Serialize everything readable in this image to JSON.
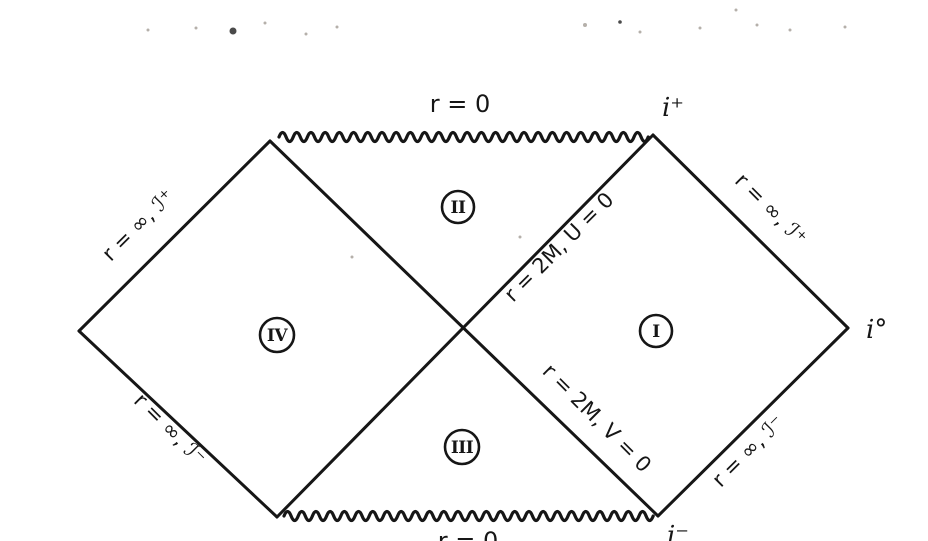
{
  "diagram": {
    "description": "Penrose conformal diagram of the maximally extended Schwarzschild spacetime",
    "ink_color": "#161616",
    "paper_color": "#ffffff",
    "singularities": {
      "top": "r = 0",
      "bottom": "r = 0"
    },
    "horizons": {
      "upper": "r = 2M, U = 0",
      "lower": "r = 2M, V = 0"
    },
    "null_infinities": {
      "left_future": "r = ∞, ℐ⁺",
      "left_past": "r = ∞, ℐ⁻",
      "right_future": "r = ∞, ℐ⁺",
      "right_past": "r = ∞, ℐ⁻"
    },
    "points": {
      "future_timelike": "i⁺",
      "spatial": "i°",
      "past_timelike": "i⁻"
    },
    "regions": {
      "I": "I",
      "II": "II",
      "III": "III",
      "IV": "IV"
    }
  }
}
